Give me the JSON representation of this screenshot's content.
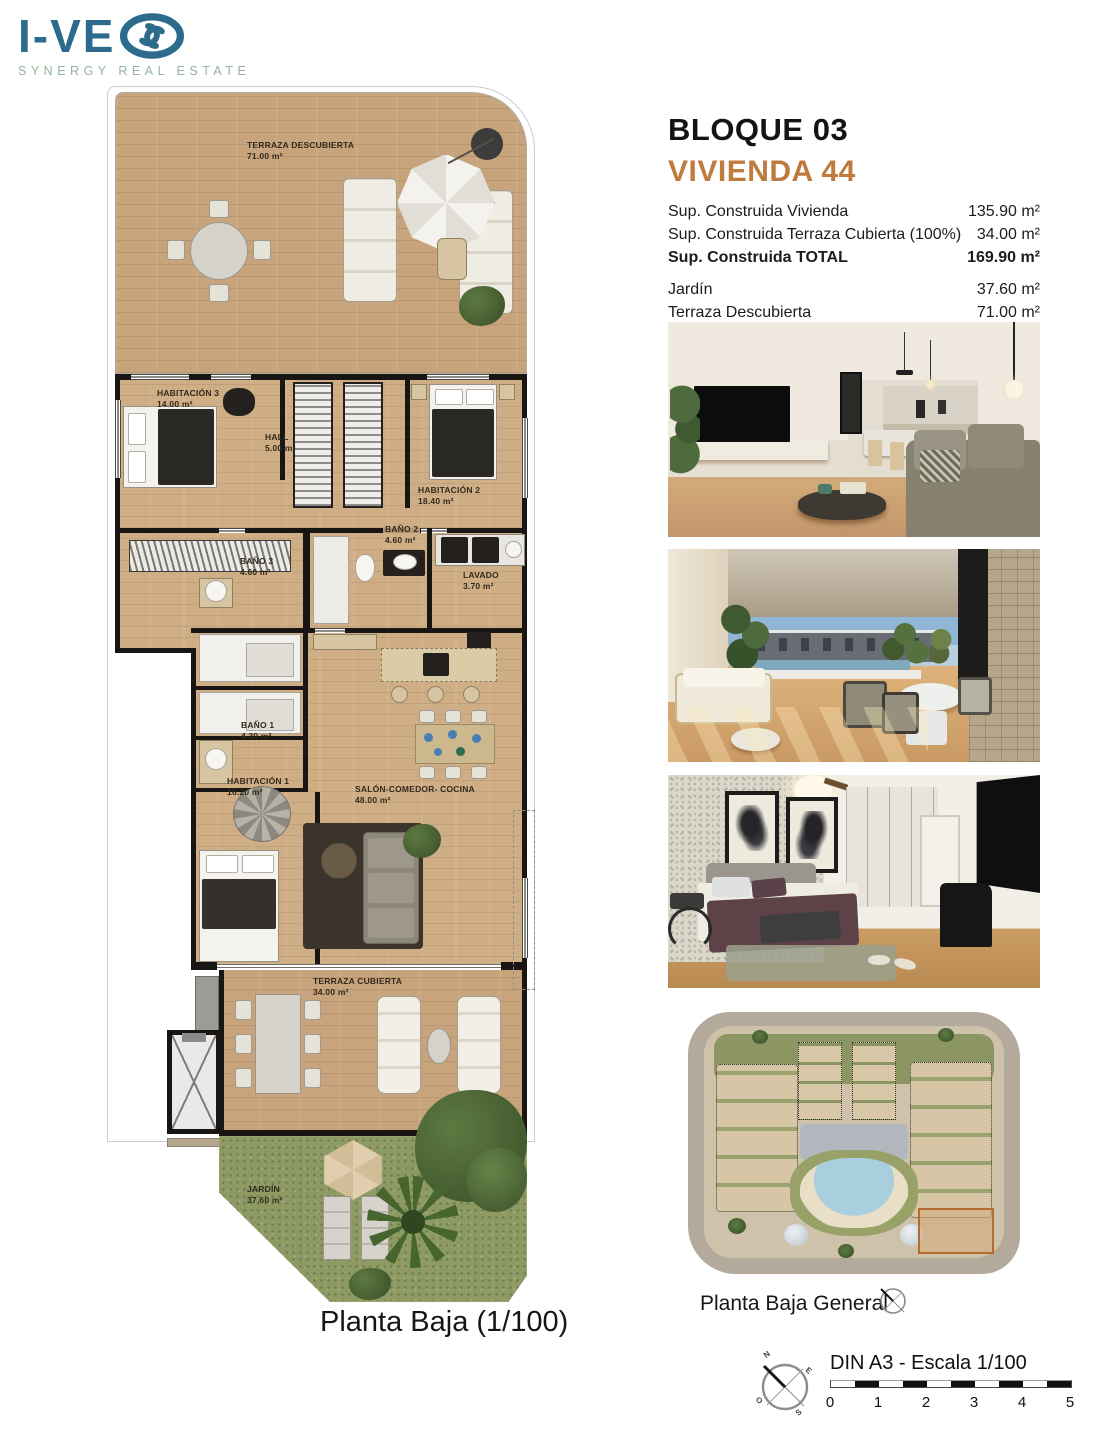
{
  "logo": {
    "brand_text": "I-VE",
    "tagline": "SYNERGY REAL ESTATE"
  },
  "header": {
    "block": "BLOQUE 03",
    "unit": "VIVIENDA 44"
  },
  "areas": {
    "rows": [
      {
        "label": "Sup. Construida Vivienda",
        "value": "135.90 m²"
      },
      {
        "label": "Sup. Construida Terraza Cubierta (100%)",
        "value": "34.00 m²"
      },
      {
        "label": "Sup. Construida TOTAL",
        "value": "169.90 m²"
      },
      {
        "label": "Jardín",
        "value": "37.60 m²"
      },
      {
        "label": "Terraza Descubierta",
        "value": "71.00 m²"
      }
    ]
  },
  "floorplan": {
    "caption": "Planta Baja (1/100)",
    "rooms": {
      "terraza_descubierta": {
        "label": "TERRAZA DESCUBIERTA",
        "area": "71.00 m²"
      },
      "habitacion3": {
        "label": "HABITACIÓN 3",
        "area": "14.00 m²"
      },
      "hall": {
        "label": "HALL",
        "area": "5.00 m²"
      },
      "habitacion2": {
        "label": "HABITACIÓN 2",
        "area": "18.40 m²"
      },
      "bano3": {
        "label": "BAÑO 3",
        "area": "4.60 m²"
      },
      "bano2": {
        "label": "BAÑO 2",
        "area": "4.60 m²"
      },
      "lavado": {
        "label": "LAVADO",
        "area": "3.70 m²"
      },
      "bano1": {
        "label": "BAÑO 1",
        "area": "4.30 m²"
      },
      "habitacion1": {
        "label": "HABITACIÓN 1",
        "area": "16.20 m²"
      },
      "salon": {
        "label": "SALÓN-COMEDOR- COCINA",
        "area": "48.00 m²"
      },
      "terraza_cubierta": {
        "label": "TERRAZA CUBIERTA",
        "area": "34.00 m²"
      },
      "jardin": {
        "label": "JARDÍN",
        "area": "37.60 m²"
      }
    }
  },
  "siteplan": {
    "caption": "Planta Baja General"
  },
  "scalebar": {
    "title": "DIN A3 - Escala 1/100",
    "ticks": [
      "0",
      "1",
      "2",
      "3",
      "4",
      "5"
    ]
  },
  "compass": {
    "n": "N",
    "e": "E",
    "s": "S",
    "o": "O"
  },
  "colors": {
    "brand_blue": "#2d6b8d",
    "brand_green": "#93b49b",
    "accent_orange": "#bf7a3e"
  }
}
